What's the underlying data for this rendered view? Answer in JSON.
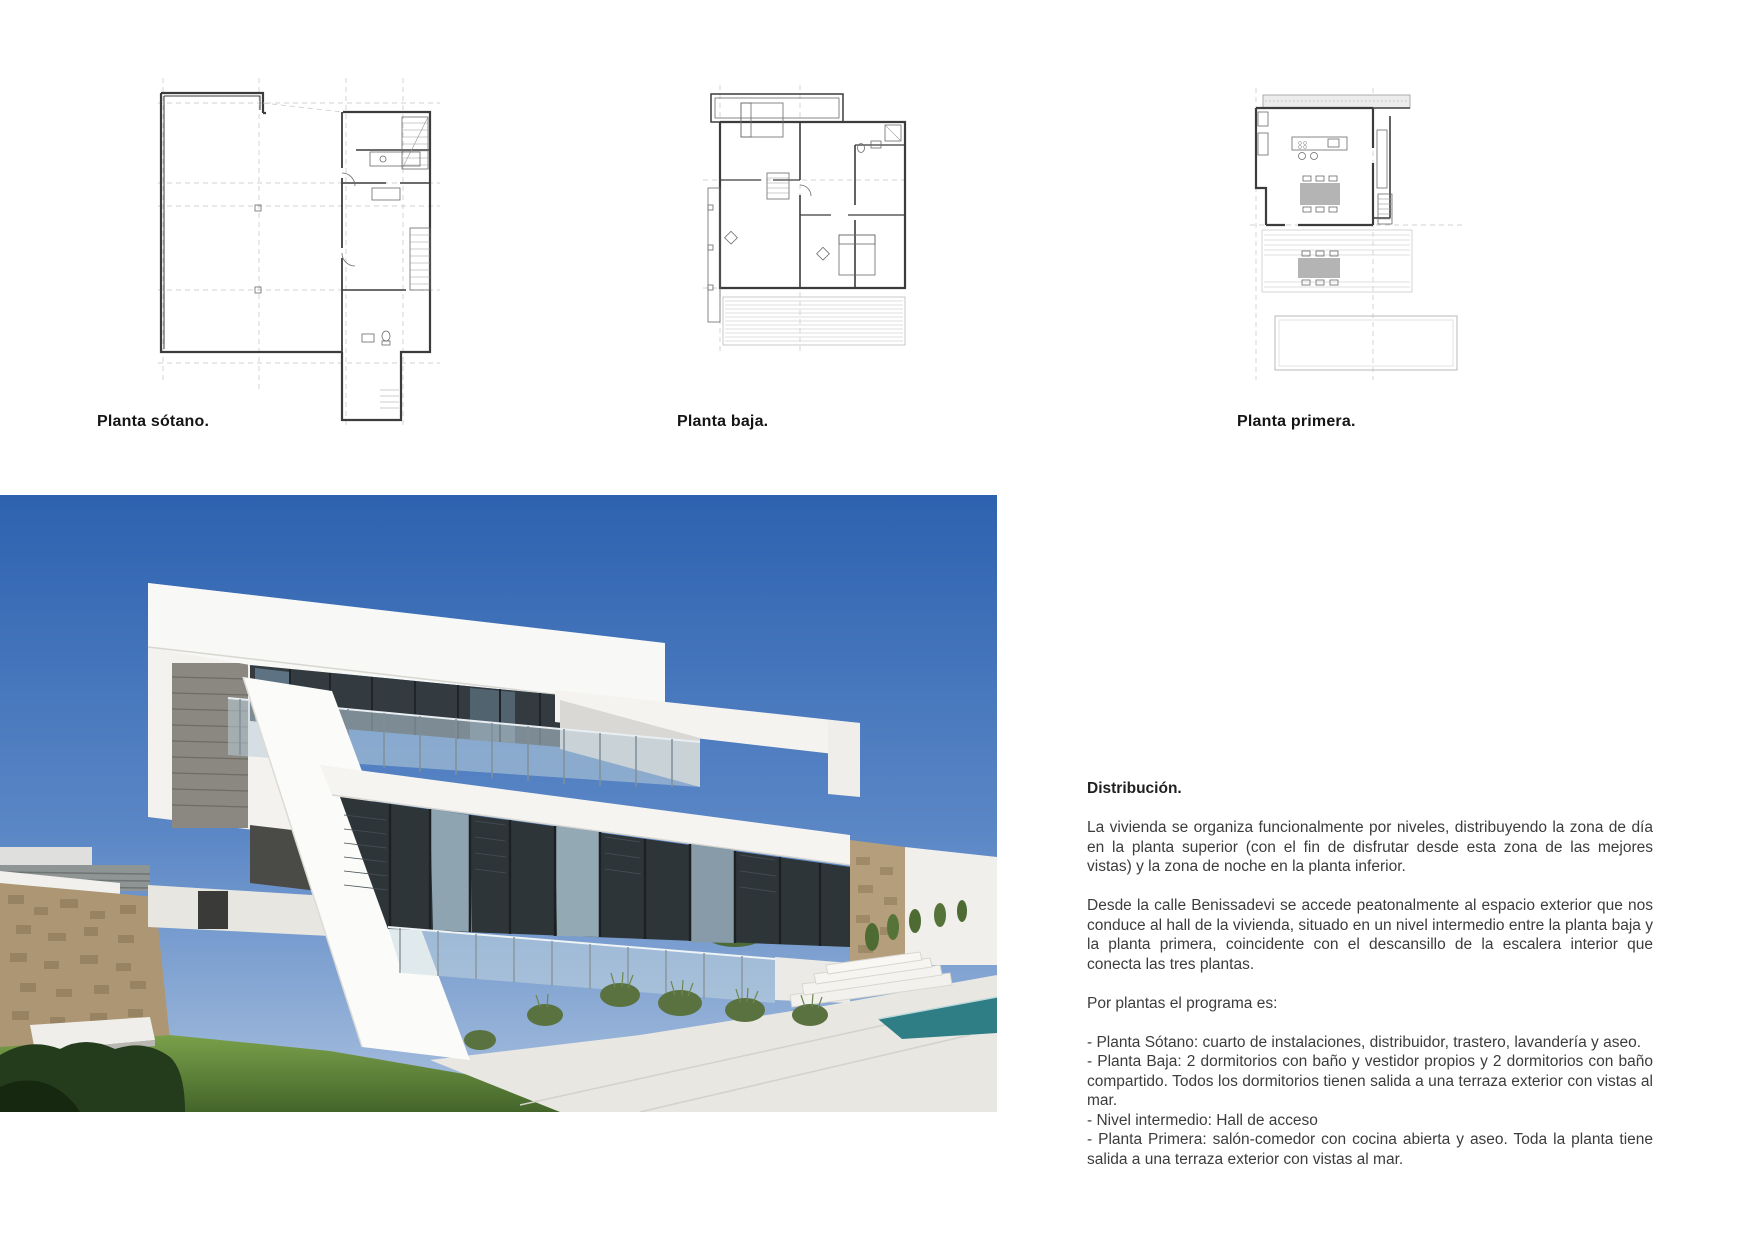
{
  "document": {
    "background": "#ffffff",
    "language": "es"
  },
  "plans": [
    {
      "id": "sotano",
      "label": "Planta sótano."
    },
    {
      "id": "baja",
      "label": "Planta baja."
    },
    {
      "id": "primera",
      "label": "Planta primera."
    }
  ],
  "photo": {
    "subject": "modern-white-villa-exterior",
    "colors": {
      "sky_top": "#2d62b0",
      "sky_horizon": "#aac1de",
      "house_white": "#f7f6f3",
      "glazing_dark": "#2e3539",
      "stone_wall": "#ac9674",
      "grass": "#5d8138",
      "pool": "#2f7e86",
      "path": "#e9e7e2"
    }
  },
  "text_block": {
    "heading": "Distribución.",
    "paragraphs": [
      "La vivienda se organiza funcionalmente por niveles, distribuyendo la zona de día en la planta superior (con el fin de disfrutar desde esta zona de las mejores vistas) y la zona de noche en la planta inferior.",
      "Desde la calle Benissadevi se accede peatonalmente al espacio exterior que nos conduce al hall de la vivienda, situado en un nivel intermedio entre la planta baja y la planta primera, coincidente con el descansillo de la escalera interior que conecta las tres plantas.",
      "Por plantas el programa es:"
    ],
    "program_items": [
      " - Planta Sótano: cuarto de instalaciones, distribuidor, trastero, lavandería y aseo.",
      "- Planta Baja: 2 dormitorios con baño y vestidor propios y 2 dormitorios con baño compartido. Todos los dormitorios tienen salida a una terraza exterior con vistas al mar.",
      "- Nivel intermedio: Hall de acceso",
      "- Planta Primera: salón-comedor con cocina abierta y aseo. Toda la planta tiene salida a una terraza exterior con vistas al mar."
    ]
  }
}
